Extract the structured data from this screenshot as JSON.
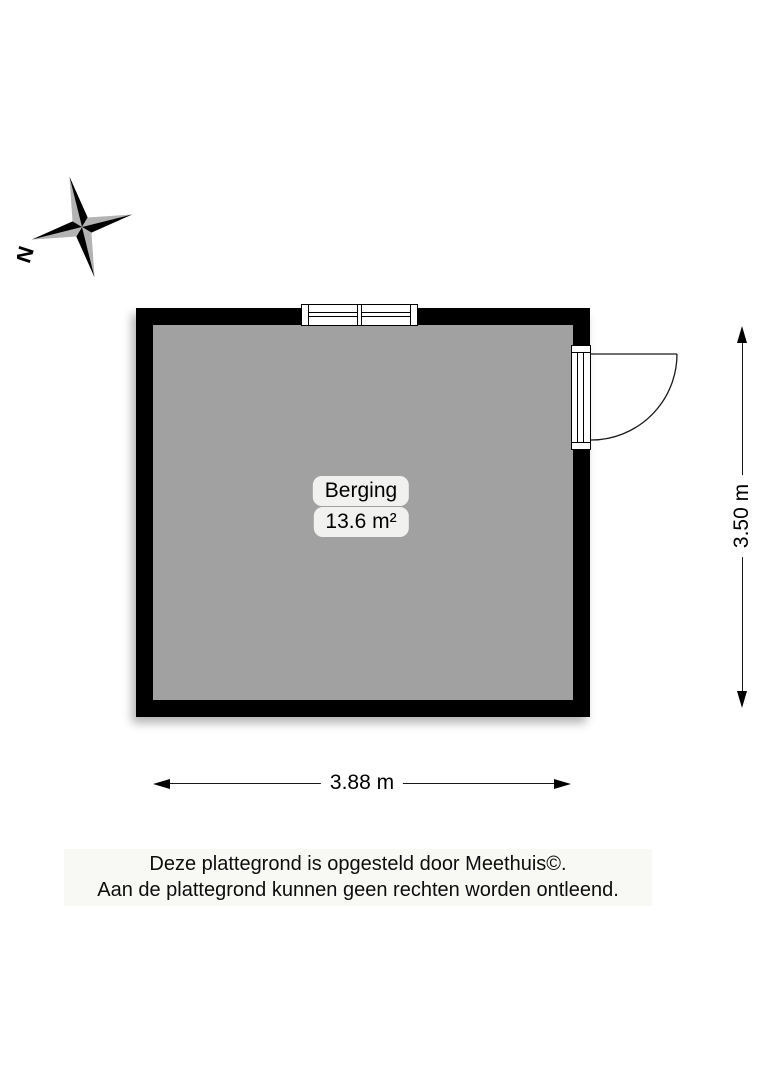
{
  "compass": {
    "north_label": "N"
  },
  "room": {
    "name": "Berging",
    "area": "13.6 m²"
  },
  "dimensions": {
    "width_label": "3.88 m",
    "height_label": "3.50 m"
  },
  "footer": {
    "line1": "Deze plattegrond is opgesteld door Meethuis©.",
    "line2": "Aan de plattegrond kunnen geen rechten worden ontleend."
  },
  "colors": {
    "wall": "#000000",
    "floor": "#a1a1a1",
    "label_pill_bg": "#f1f1ef",
    "footer_bg": "#f8f8f5",
    "compass_gray": "#b3b3b3"
  }
}
